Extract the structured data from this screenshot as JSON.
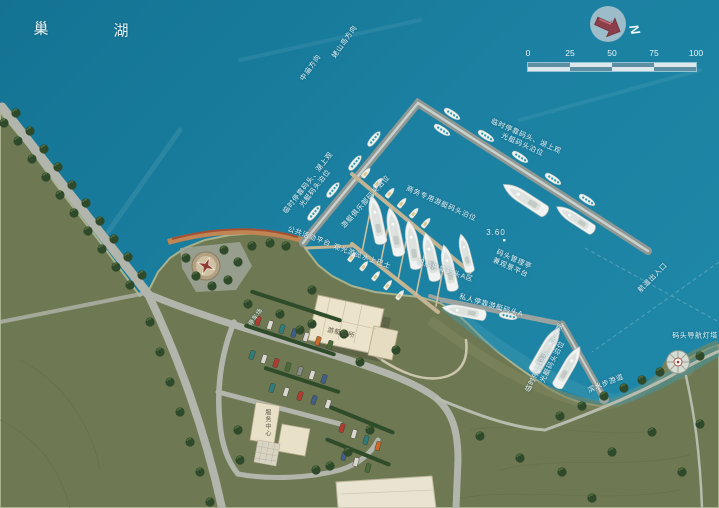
{
  "lake": {
    "name_char_1": "巢",
    "name_char_2": "湖"
  },
  "compass": {
    "north": "N"
  },
  "scale_bar": {
    "ticks": [
      "0",
      "25",
      "50",
      "75",
      "100"
    ]
  },
  "labels": {
    "direction_laoshan": "姥山岛方向",
    "direction_zhongmiao": "中庙方向",
    "temporary_berth_line1": "临时停靠码头、湖上观",
    "temporary_berth_line2": "光艇码头泊位",
    "marina_club_berths": "游艇俱乐部码头泊位",
    "business_yacht_berths": "商务专用游艇码头泊位",
    "elevation": "3.60",
    "dock_office_line1": "码头管理亭",
    "dock_office_line2": "兼观景平台",
    "public_platform": "公共活动平台",
    "sightseeing_water_bus": "观光游览水上巴士",
    "sailboat_dock": "帆船停靠码头A区",
    "private_yacht_dock": "私人停靠游艇码头A",
    "channel_entrance": "航道出入口",
    "navigation_lighthouse": "码头导航灯塔",
    "waterfront_walkway": "滨水步游道",
    "clubhouse": "游艇会所",
    "service_center": "服务中心",
    "parking_lot": "停车场"
  },
  "colors": {
    "water": "#1b80a1",
    "land": "#6e7852",
    "pier": "#9aa3a0",
    "accent_red": "#8d3f49"
  }
}
